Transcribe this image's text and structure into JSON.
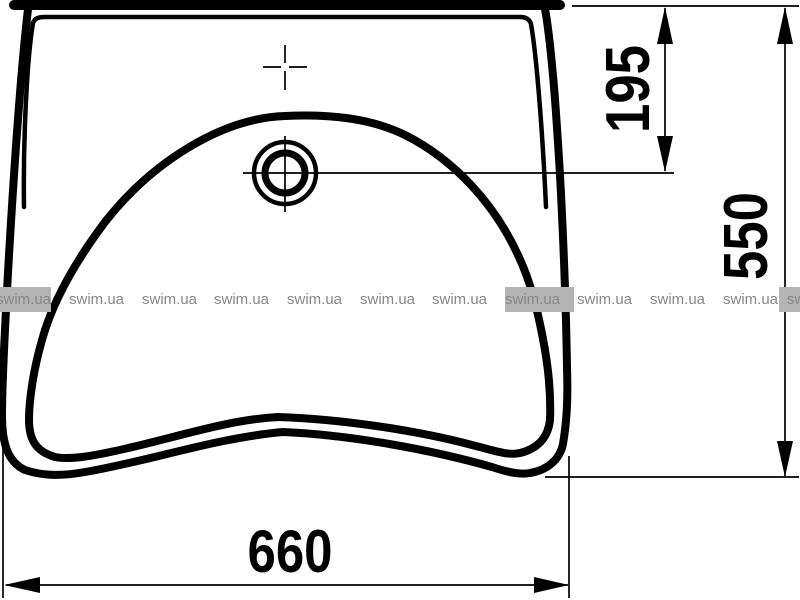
{
  "drawing": {
    "dimensions": {
      "width": {
        "label": "660"
      },
      "height": {
        "label": "550"
      },
      "tap_to_drain": {
        "label": "195"
      }
    }
  },
  "watermark": {
    "text": "swim.ua",
    "text_color": "#878787",
    "highlight_color": "#b4b4b4",
    "instances": [
      {
        "x": -4,
        "highlighted": true
      },
      {
        "x": 69,
        "highlighted": false
      },
      {
        "x": 142,
        "highlighted": false
      },
      {
        "x": 214,
        "highlighted": false
      },
      {
        "x": 287,
        "highlighted": false
      },
      {
        "x": 360,
        "highlighted": false
      },
      {
        "x": 432,
        "highlighted": false
      },
      {
        "x": 505,
        "highlighted": true,
        "pad_right": 14
      },
      {
        "x": 577,
        "highlighted": false
      },
      {
        "x": 650,
        "highlighted": false
      },
      {
        "x": 723,
        "highlighted": false
      },
      {
        "x": 787,
        "highlighted": true,
        "pad_left": 8
      }
    ]
  },
  "colors": {
    "line": "#000000",
    "background": "#ffffff"
  }
}
